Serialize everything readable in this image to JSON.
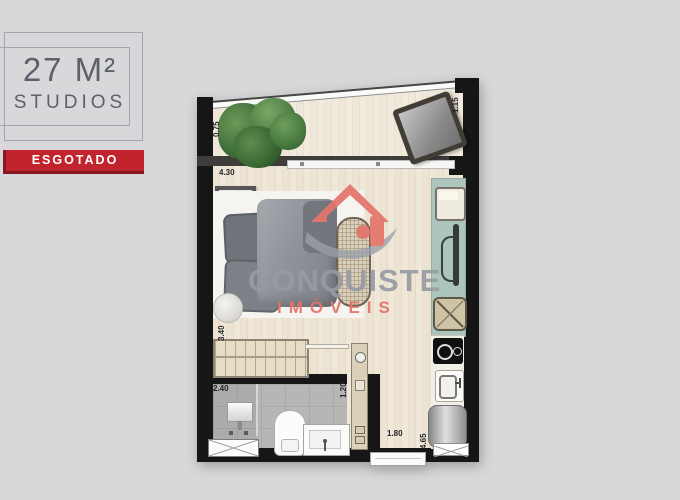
{
  "header": {
    "area": "27 M²",
    "type": "STUDIOS",
    "status": "ESGOTADO"
  },
  "watermark": {
    "brand": "CONQUISTE",
    "brand_sub": "IMÓVEIS"
  },
  "measurements": {
    "balcony_depth": "0.75",
    "balcony_width": "1.15",
    "living_width": "4.30",
    "living_depth": "3.40",
    "bath_width": "2.40",
    "bath_passage": "1.20",
    "entry_width": "1.80",
    "unit_depth": "4.65"
  },
  "colors": {
    "badge_red": "#c2242e",
    "brand_accent": "#e4756b",
    "brand_gray": "#9aa0a8",
    "counter_teal": "#abc4bc",
    "background": "#d8d8da",
    "wall": "#161616"
  },
  "furniture": [
    "plants",
    "lounger",
    "bed",
    "pillows",
    "duvet",
    "side-table",
    "wall-frame",
    "bench",
    "wardrobe",
    "tv-rack",
    "tray",
    "tv",
    "basket",
    "cooktop",
    "kitchen-sink",
    "washer",
    "doormat",
    "shower",
    "shower-mat",
    "toilet",
    "vanity",
    "sliding-door",
    "entry-door"
  ]
}
